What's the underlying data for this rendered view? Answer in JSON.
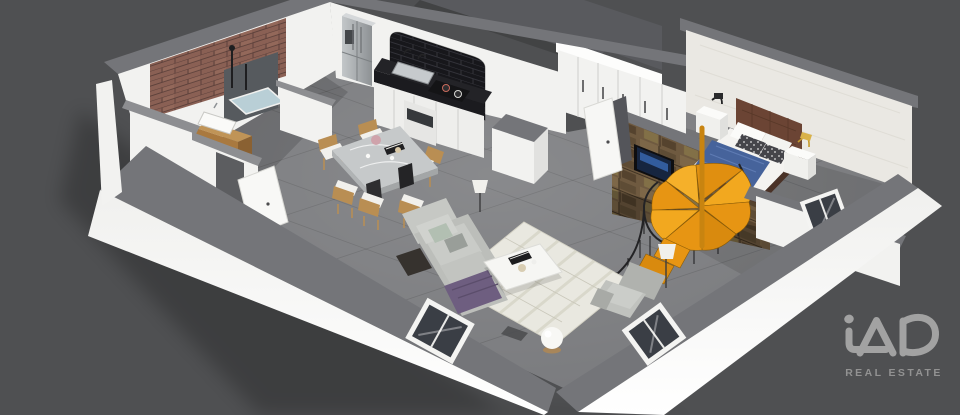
{
  "meta": {
    "description": "3D isometric render of a one-bedroom loft apartment floor plan on a dark grey background",
    "style": "isometric-3d-floorplan"
  },
  "branding": {
    "logo_text": "iAD",
    "tagline": "REAL ESTATE"
  },
  "colors": {
    "background": "#4f5052",
    "slab": "#595a5e",
    "floor": "#797a7d",
    "wall_white": "#f2f2f0",
    "wall_bright": "#fdfdfc",
    "wall_cap": "#747579",
    "cap_light": "#8d8e91",
    "brick_red": "#8a6054",
    "brick_black": "#17171b",
    "stone": "#6f5a40",
    "counter_black": "#232327",
    "cabinet": "#eeeeec",
    "steel": "#a9adb0",
    "wood": "#a9793f",
    "marble": "#c6c9ca",
    "chair_wood": "#b98e53",
    "rug": "#e9e8e0",
    "sofa": "#bcbeba",
    "cushion_green": "#b2bfb2",
    "purple": "#6e5e80",
    "bed_blue": "#46639b",
    "headboard": "#6b4434",
    "frame_brown": "#4a3227",
    "stair_orange": "#e79513",
    "railing": "#232325",
    "glass": "#3a3e45",
    "tv_screen": "#16253f",
    "gold": "#c59a2b",
    "lamp_shade": "#f1f0ec",
    "logo": "#a2a2a2",
    "logo_sub": "#929292"
  },
  "scene": {
    "rooms": [
      {
        "name": "Bathroom",
        "objects": [
          "red brick feature wall",
          "walk-in shower",
          "shower tray",
          "black shower fixtures",
          "wood vanity unit",
          "white basin",
          "white partition walls",
          "door"
        ]
      },
      {
        "name": "Kitchen",
        "objects": [
          "stainless fridge freezer",
          "arched black brick alcove",
          "black stone countertop",
          "double sink with faucets",
          "cooktop with pans",
          "oven",
          "white base cabinets",
          "storage column"
        ]
      },
      {
        "name": "Dining area",
        "objects": [
          "marble dining table",
          "6 wooden chairs with white cushions",
          "flower vase",
          "books",
          "cups"
        ]
      },
      {
        "name": "Living room",
        "objects": [
          "patterned area rug",
          "grey fabric sofa",
          "sage green cushion",
          "chaise with purple throw",
          "white coffee table",
          "books and bowl decor",
          "grey armchair",
          "floor lamp",
          "globe floor lamp",
          "floor vents"
        ]
      },
      {
        "name": "Bedroom",
        "objects": [
          "double bed with blue duvet",
          "brown tufted headboard",
          "patterned pillows",
          "two white nightstands",
          "black table lamp",
          "gold table lamp",
          "white wardrobe row",
          "entry closets",
          "textured wallpaper wall",
          "low front wall with window"
        ]
      },
      {
        "name": "Stair area",
        "objects": [
          "rustic stone feature wall",
          "wall mounted tv",
          "orange spiral staircase",
          "black spiral railing",
          "open white door"
        ]
      }
    ],
    "counts": {
      "windows": 3,
      "doors": 2,
      "dining_chairs": 6
    },
    "upper_level": "dark mezzanine slab above the kitchen corner"
  }
}
